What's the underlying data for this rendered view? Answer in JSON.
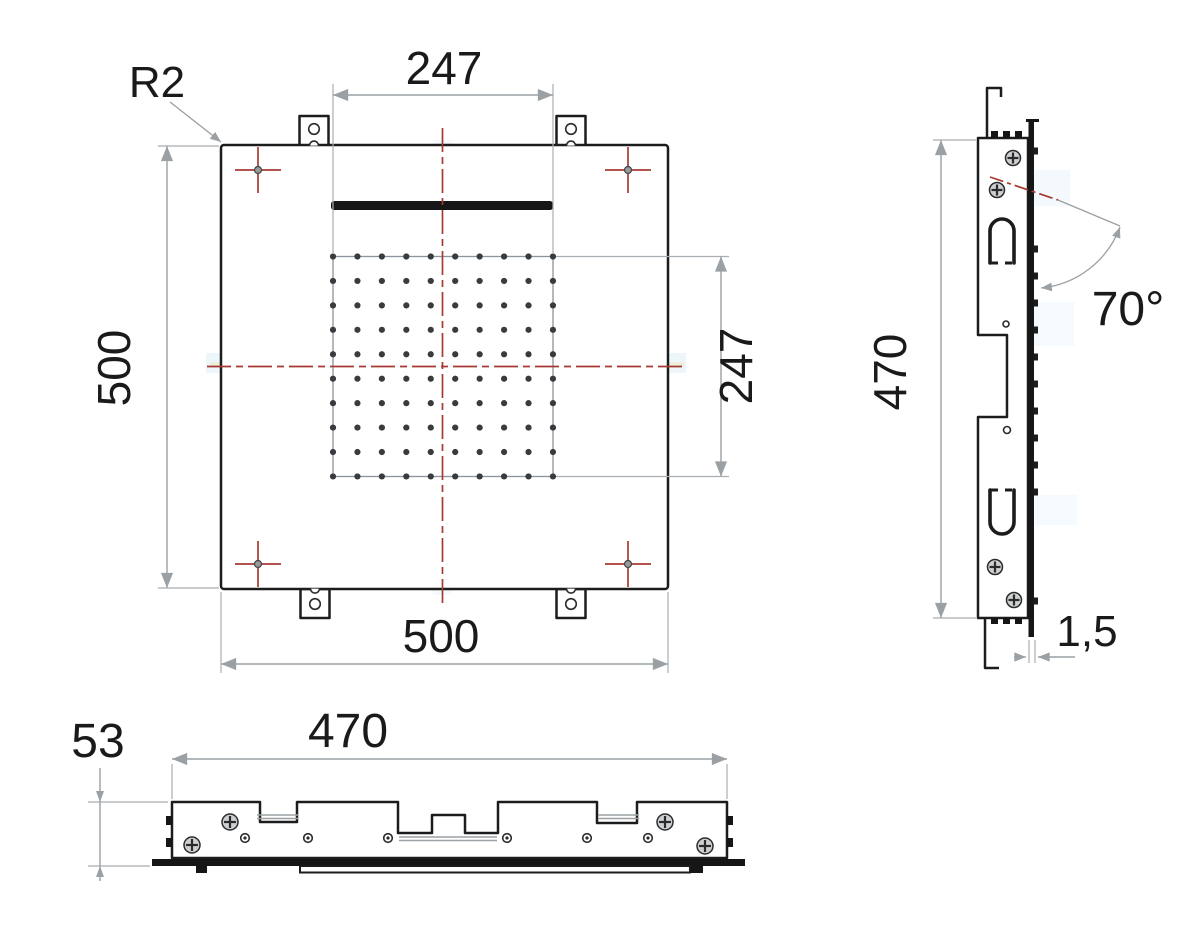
{
  "labels": {
    "front": {
      "corner_radius": "R2",
      "nozzle_field_width": "247",
      "plate_height": "500",
      "plate_width": "500",
      "nozzle_field_height": "247"
    },
    "side": {
      "height": "470",
      "spray_angle": "70°",
      "panel_thickness": "1,5"
    },
    "bottom": {
      "depth": "53",
      "width": "470"
    }
  },
  "nozzle_grid": {
    "rows": 10,
    "cols": 10,
    "x0": 333,
    "y0": 256.5,
    "spacing": 24.44,
    "dot_radius": 3.1,
    "dot_color": "#383c3f"
  },
  "side_nozzle_ticks": {
    "x": 1033.5,
    "width": 4.5,
    "height": 7,
    "y_centers": [
      151,
      249,
      276,
      303,
      330,
      357,
      384,
      411,
      438,
      465,
      492,
      601
    ],
    "color": "#1c1c1c"
  },
  "colors": {
    "outline": "#1c1c1c",
    "dimension_gray": "#9aa0a4",
    "centerline_red": "#a63a32",
    "artifact_blue": "#dcedf8",
    "artifact_yellow": "#efe9c4",
    "background": "#ffffff"
  }
}
